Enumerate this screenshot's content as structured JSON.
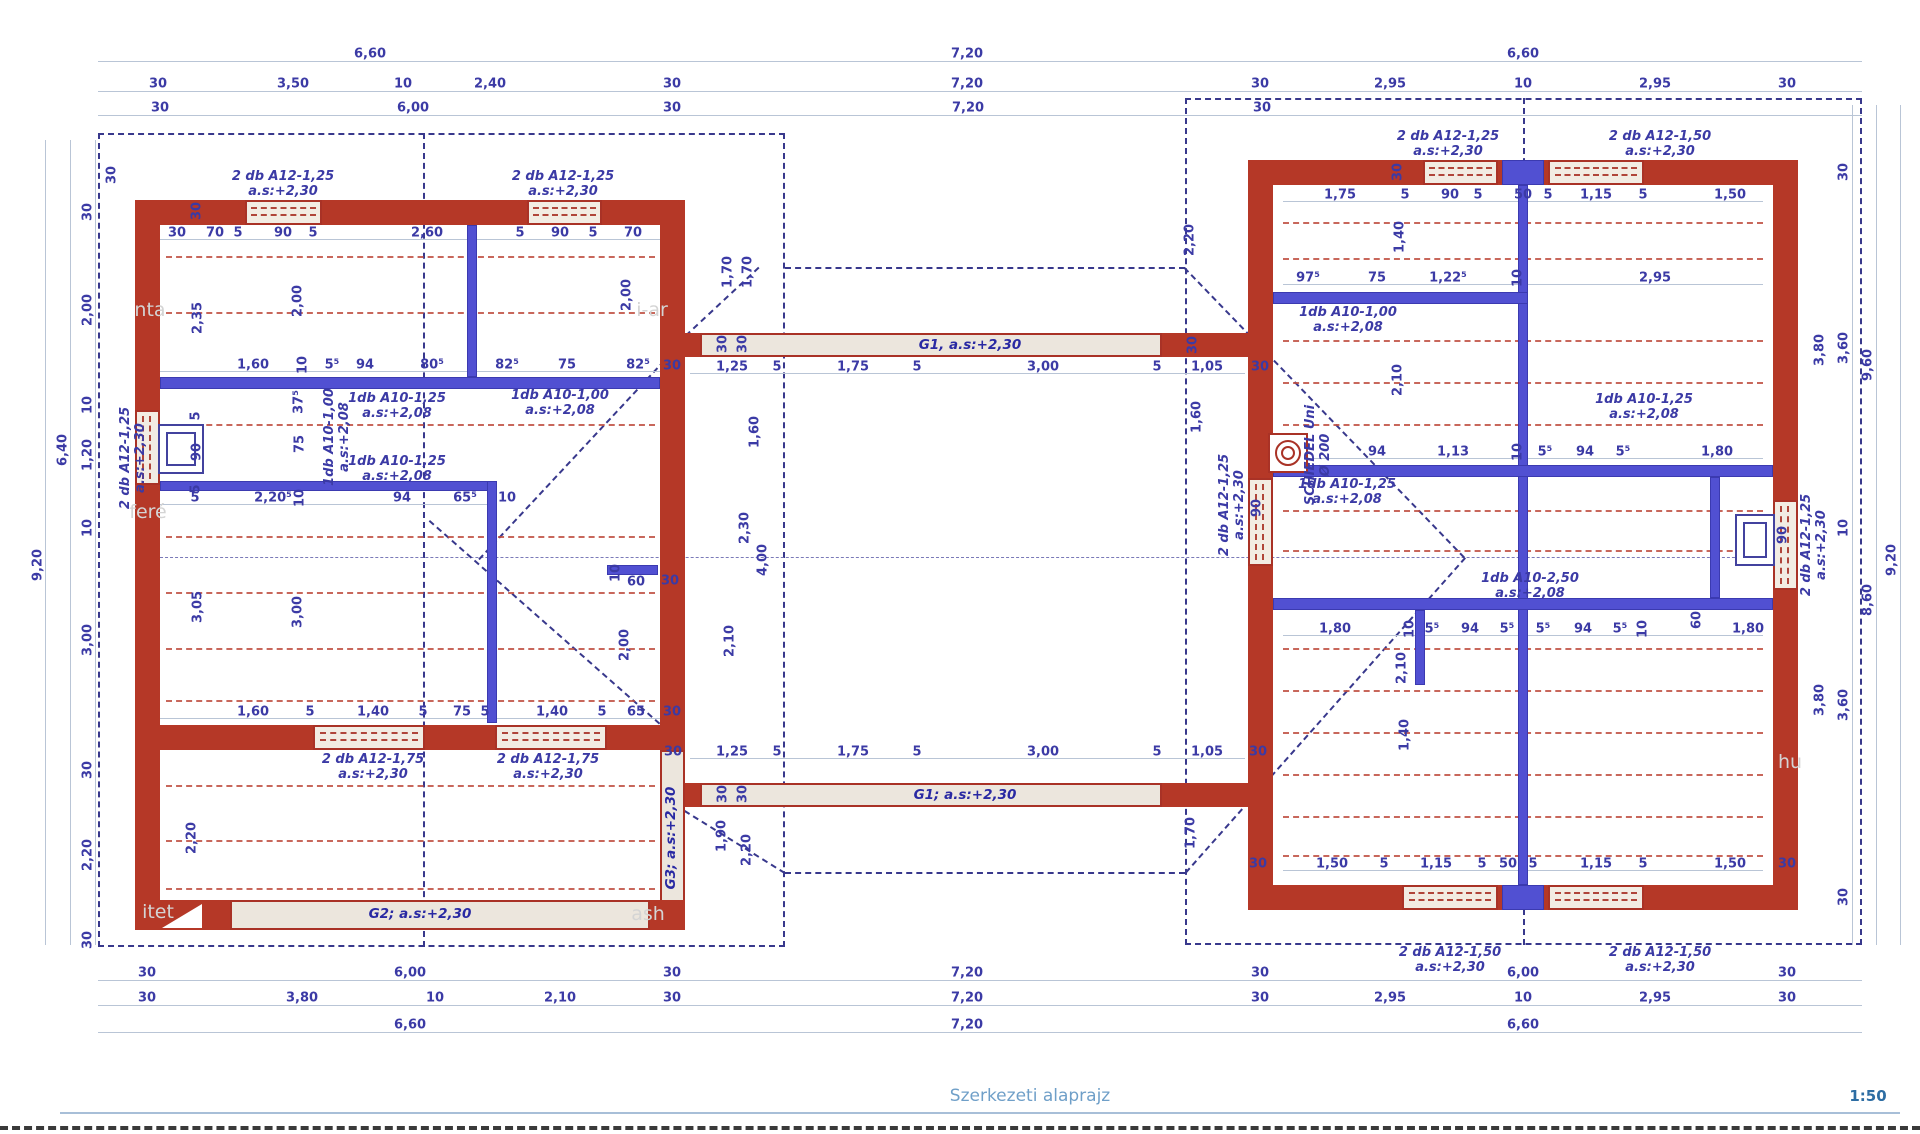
{
  "meta": {
    "title": "Szerkezeti alaprajz",
    "scale": "1:50"
  },
  "colors": {
    "wall": "#b53827",
    "reinforcement_blue": "#5150d2",
    "dimension_text": "#3b3aa5",
    "roof_dash": "#38388c",
    "slab_line": "#bf4d3f",
    "title": "#6f9fc8",
    "scale_text": "#2d6da3"
  },
  "dims": [
    {
      "t": "6,60",
      "x": 370,
      "y": 54
    },
    {
      "t": "7,20",
      "x": 967,
      "y": 54
    },
    {
      "t": "6,60",
      "x": 1523,
      "y": 54
    },
    {
      "t": "30",
      "x": 158,
      "y": 84
    },
    {
      "t": "3,50",
      "x": 293,
      "y": 84
    },
    {
      "t": "10",
      "x": 403,
      "y": 84
    },
    {
      "t": "2,40",
      "x": 490,
      "y": 84
    },
    {
      "t": "30",
      "x": 672,
      "y": 84
    },
    {
      "t": "7,20",
      "x": 967,
      "y": 84
    },
    {
      "t": "30",
      "x": 1260,
      "y": 84
    },
    {
      "t": "2,95",
      "x": 1390,
      "y": 84
    },
    {
      "t": "10",
      "x": 1523,
      "y": 84
    },
    {
      "t": "2,95",
      "x": 1655,
      "y": 84
    },
    {
      "t": "30",
      "x": 1787,
      "y": 84
    },
    {
      "t": "30",
      "x": 160,
      "y": 108
    },
    {
      "t": "6,00",
      "x": 413,
      "y": 108
    },
    {
      "t": "30",
      "x": 672,
      "y": 108
    },
    {
      "t": "7,20",
      "x": 968,
      "y": 108
    },
    {
      "t": "30",
      "x": 1262,
      "y": 108
    },
    {
      "t": "30",
      "x": 177,
      "y": 233
    },
    {
      "t": "70",
      "x": 215,
      "y": 233
    },
    {
      "t": "5",
      "x": 238,
      "y": 233
    },
    {
      "t": "90",
      "x": 283,
      "y": 233
    },
    {
      "t": "5",
      "x": 313,
      "y": 233
    },
    {
      "t": "2,60",
      "x": 427,
      "y": 233
    },
    {
      "t": "5",
      "x": 520,
      "y": 233
    },
    {
      "t": "90",
      "x": 560,
      "y": 233
    },
    {
      "t": "5",
      "x": 593,
      "y": 233
    },
    {
      "t": "70",
      "x": 633,
      "y": 233
    },
    {
      "t": "30",
      "x": 197,
      "y": 211,
      "r": 1
    },
    {
      "t": "2,35",
      "x": 198,
      "y": 318,
      "r": 1
    },
    {
      "t": "2,00",
      "x": 298,
      "y": 301,
      "r": 1
    },
    {
      "t": "2,00",
      "x": 627,
      "y": 295,
      "r": 1
    },
    {
      "t": "1,60",
      "x": 253,
      "y": 365
    },
    {
      "t": "10",
      "x": 303,
      "y": 365,
      "r": 1
    },
    {
      "t": "5⁵",
      "x": 332,
      "y": 365
    },
    {
      "t": "94",
      "x": 365,
      "y": 365
    },
    {
      "t": "80⁵",
      "x": 432,
      "y": 365
    },
    {
      "t": "82⁵",
      "x": 507,
      "y": 365
    },
    {
      "t": "75",
      "x": 567,
      "y": 365
    },
    {
      "t": "82⁵",
      "x": 638,
      "y": 365
    },
    {
      "t": "30",
      "x": 672,
      "y": 366
    },
    {
      "t": "37⁵",
      "x": 299,
      "y": 402,
      "r": 1
    },
    {
      "t": "75",
      "x": 300,
      "y": 444,
      "r": 1
    },
    {
      "t": "5",
      "x": 196,
      "y": 416,
      "r": 1
    },
    {
      "t": "90",
      "x": 197,
      "y": 452,
      "r": 1
    },
    {
      "t": "5",
      "x": 196,
      "y": 489,
      "r": 1
    },
    {
      "t": "5",
      "x": 195,
      "y": 498
    },
    {
      "t": "2,20⁵",
      "x": 273,
      "y": 498
    },
    {
      "t": "10",
      "x": 300,
      "y": 498,
      "r": 1
    },
    {
      "t": "94",
      "x": 402,
      "y": 498
    },
    {
      "t": "65⁵",
      "x": 465,
      "y": 498
    },
    {
      "t": "10",
      "x": 507,
      "y": 498
    },
    {
      "t": "10",
      "x": 616,
      "y": 573,
      "r": 1
    },
    {
      "t": "60",
      "x": 636,
      "y": 582
    },
    {
      "t": "30",
      "x": 670,
      "y": 581
    },
    {
      "t": "3,05",
      "x": 198,
      "y": 607,
      "r": 1
    },
    {
      "t": "3,00",
      "x": 298,
      "y": 612,
      "r": 1
    },
    {
      "t": "2,00",
      "x": 625,
      "y": 645,
      "r": 1
    },
    {
      "t": "1,60",
      "x": 253,
      "y": 712
    },
    {
      "t": "5",
      "x": 310,
      "y": 712
    },
    {
      "t": "1,40",
      "x": 373,
      "y": 712
    },
    {
      "t": "5",
      "x": 423,
      "y": 712
    },
    {
      "t": "75",
      "x": 462,
      "y": 712
    },
    {
      "t": "5",
      "x": 485,
      "y": 712
    },
    {
      "t": "1,40",
      "x": 552,
      "y": 712
    },
    {
      "t": "5",
      "x": 602,
      "y": 712
    },
    {
      "t": "65",
      "x": 636,
      "y": 712
    },
    {
      "t": "30",
      "x": 672,
      "y": 712
    },
    {
      "t": "2,20",
      "x": 192,
      "y": 838,
      "r": 1
    },
    {
      "t": "30",
      "x": 88,
      "y": 212,
      "r": 1
    },
    {
      "t": "2,00",
      "x": 88,
      "y": 310,
      "r": 1
    },
    {
      "t": "10",
      "x": 88,
      "y": 405,
      "r": 1
    },
    {
      "t": "1,20",
      "x": 88,
      "y": 455,
      "r": 1
    },
    {
      "t": "10",
      "x": 88,
      "y": 528,
      "r": 1
    },
    {
      "t": "3,00",
      "x": 88,
      "y": 640,
      "r": 1
    },
    {
      "t": "30",
      "x": 88,
      "y": 770,
      "r": 1
    },
    {
      "t": "2,20",
      "x": 88,
      "y": 855,
      "r": 1
    },
    {
      "t": "30",
      "x": 88,
      "y": 940,
      "r": 1
    },
    {
      "t": "30",
      "x": 112,
      "y": 175,
      "r": 1
    },
    {
      "t": "6,40",
      "x": 63,
      "y": 450,
      "r": 1
    },
    {
      "t": "9,20",
      "x": 38,
      "y": 565,
      "r": 1
    },
    {
      "t": "1,70",
      "x": 728,
      "y": 272,
      "r": 1
    },
    {
      "t": "1,70",
      "x": 748,
      "y": 272,
      "r": 1
    },
    {
      "t": "1,25",
      "x": 732,
      "y": 367
    },
    {
      "t": "5",
      "x": 777,
      "y": 367
    },
    {
      "t": "1,75",
      "x": 853,
      "y": 367
    },
    {
      "t": "5",
      "x": 917,
      "y": 367
    },
    {
      "t": "3,00",
      "x": 1043,
      "y": 367
    },
    {
      "t": "5",
      "x": 1157,
      "y": 367
    },
    {
      "t": "1,05",
      "x": 1207,
      "y": 367
    },
    {
      "t": "30",
      "x": 1260,
      "y": 367
    },
    {
      "t": "30",
      "x": 723,
      "y": 344,
      "r": 1
    },
    {
      "t": "30",
      "x": 743,
      "y": 344,
      "r": 1
    },
    {
      "t": "30",
      "x": 1193,
      "y": 345,
      "r": 1
    },
    {
      "t": "2,20",
      "x": 1190,
      "y": 240,
      "r": 1
    },
    {
      "t": "1,60",
      "x": 755,
      "y": 432,
      "r": 1
    },
    {
      "t": "2,30",
      "x": 745,
      "y": 528,
      "r": 1
    },
    {
      "t": "4,00",
      "x": 763,
      "y": 560,
      "r": 1
    },
    {
      "t": "2,10",
      "x": 730,
      "y": 641,
      "r": 1
    },
    {
      "t": "30",
      "x": 673,
      "y": 752
    },
    {
      "t": "1,25",
      "x": 732,
      "y": 752
    },
    {
      "t": "5",
      "x": 777,
      "y": 752
    },
    {
      "t": "1,75",
      "x": 853,
      "y": 752
    },
    {
      "t": "5",
      "x": 917,
      "y": 752
    },
    {
      "t": "3,00",
      "x": 1043,
      "y": 752
    },
    {
      "t": "5",
      "x": 1157,
      "y": 752
    },
    {
      "t": "1,05",
      "x": 1207,
      "y": 752
    },
    {
      "t": "30",
      "x": 1258,
      "y": 752
    },
    {
      "t": "30",
      "x": 723,
      "y": 794,
      "r": 1
    },
    {
      "t": "30",
      "x": 743,
      "y": 794,
      "r": 1
    },
    {
      "t": "1,90",
      "x": 722,
      "y": 836,
      "r": 1
    },
    {
      "t": "2,20",
      "x": 747,
      "y": 850,
      "r": 1
    },
    {
      "t": "1,70",
      "x": 1191,
      "y": 833,
      "r": 1
    },
    {
      "t": "1,60",
      "x": 1197,
      "y": 417,
      "r": 1
    },
    {
      "t": "1,75",
      "x": 1340,
      "y": 195
    },
    {
      "t": "5",
      "x": 1405,
      "y": 195
    },
    {
      "t": "90",
      "x": 1450,
      "y": 195
    },
    {
      "t": "5",
      "x": 1478,
      "y": 195
    },
    {
      "t": "50",
      "x": 1523,
      "y": 195
    },
    {
      "t": "5",
      "x": 1548,
      "y": 195
    },
    {
      "t": "1,15",
      "x": 1596,
      "y": 195
    },
    {
      "t": "5",
      "x": 1643,
      "y": 195
    },
    {
      "t": "1,50",
      "x": 1730,
      "y": 195
    },
    {
      "t": "30",
      "x": 1398,
      "y": 172,
      "r": 1
    },
    {
      "t": "97⁵",
      "x": 1308,
      "y": 278
    },
    {
      "t": "75",
      "x": 1377,
      "y": 278
    },
    {
      "t": "1,22⁵",
      "x": 1448,
      "y": 278
    },
    {
      "t": "10",
      "x": 1518,
      "y": 278,
      "r": 1
    },
    {
      "t": "2,95",
      "x": 1655,
      "y": 278
    },
    {
      "t": "1,40",
      "x": 1400,
      "y": 237,
      "r": 1
    },
    {
      "t": "2,10",
      "x": 1398,
      "y": 380,
      "r": 1
    },
    {
      "t": "94",
      "x": 1377,
      "y": 452
    },
    {
      "t": "1,13",
      "x": 1453,
      "y": 452
    },
    {
      "t": "10",
      "x": 1518,
      "y": 452,
      "r": 1
    },
    {
      "t": "5⁵",
      "x": 1545,
      "y": 452
    },
    {
      "t": "94",
      "x": 1585,
      "y": 452
    },
    {
      "t": "5⁵",
      "x": 1623,
      "y": 452
    },
    {
      "t": "1,80",
      "x": 1717,
      "y": 452
    },
    {
      "t": "1,80",
      "x": 1335,
      "y": 629
    },
    {
      "t": "10",
      "x": 1410,
      "y": 629,
      "r": 1
    },
    {
      "t": "5⁵",
      "x": 1432,
      "y": 629
    },
    {
      "t": "94",
      "x": 1470,
      "y": 629
    },
    {
      "t": "5⁵",
      "x": 1507,
      "y": 629
    },
    {
      "t": "5⁵",
      "x": 1543,
      "y": 629
    },
    {
      "t": "94",
      "x": 1583,
      "y": 629
    },
    {
      "t": "5⁵",
      "x": 1620,
      "y": 629
    },
    {
      "t": "10",
      "x": 1643,
      "y": 629,
      "r": 1
    },
    {
      "t": "60",
      "x": 1697,
      "y": 620,
      "r": 1
    },
    {
      "t": "1,80",
      "x": 1748,
      "y": 629
    },
    {
      "t": "2,10",
      "x": 1402,
      "y": 668,
      "r": 1
    },
    {
      "t": "1,40",
      "x": 1405,
      "y": 735,
      "r": 1
    },
    {
      "t": "30",
      "x": 1258,
      "y": 864
    },
    {
      "t": "1,50",
      "x": 1332,
      "y": 864
    },
    {
      "t": "5",
      "x": 1384,
      "y": 864
    },
    {
      "t": "1,15",
      "x": 1436,
      "y": 864
    },
    {
      "t": "5",
      "x": 1482,
      "y": 864
    },
    {
      "t": "50",
      "x": 1508,
      "y": 864
    },
    {
      "t": "5",
      "x": 1533,
      "y": 864
    },
    {
      "t": "1,15",
      "x": 1596,
      "y": 864
    },
    {
      "t": "5",
      "x": 1643,
      "y": 864
    },
    {
      "t": "1,50",
      "x": 1730,
      "y": 864
    },
    {
      "t": "30",
      "x": 1787,
      "y": 864
    },
    {
      "t": "90",
      "x": 1257,
      "y": 508,
      "r": 1
    },
    {
      "t": "90",
      "x": 1783,
      "y": 535,
      "r": 1
    },
    {
      "t": "3,80",
      "x": 1820,
      "y": 350,
      "r": 1
    },
    {
      "t": "3,80",
      "x": 1820,
      "y": 700,
      "r": 1
    },
    {
      "t": "30",
      "x": 1844,
      "y": 172,
      "r": 1
    },
    {
      "t": "3,60",
      "x": 1844,
      "y": 348,
      "r": 1
    },
    {
      "t": "10",
      "x": 1844,
      "y": 528,
      "r": 1
    },
    {
      "t": "3,60",
      "x": 1844,
      "y": 705,
      "r": 1
    },
    {
      "t": "30",
      "x": 1844,
      "y": 897,
      "r": 1
    },
    {
      "t": "9,60",
      "x": 1868,
      "y": 365,
      "r": 1
    },
    {
      "t": "8,60",
      "x": 1868,
      "y": 600,
      "r": 1
    },
    {
      "t": "9,20",
      "x": 1892,
      "y": 560,
      "r": 1
    },
    {
      "t": "30",
      "x": 147,
      "y": 973
    },
    {
      "t": "6,00",
      "x": 410,
      "y": 973
    },
    {
      "t": "30",
      "x": 672,
      "y": 973
    },
    {
      "t": "7,20",
      "x": 967,
      "y": 973
    },
    {
      "t": "30",
      "x": 1260,
      "y": 973
    },
    {
      "t": "6,00",
      "x": 1523,
      "y": 973
    },
    {
      "t": "30",
      "x": 1787,
      "y": 973
    },
    {
      "t": "30",
      "x": 147,
      "y": 998
    },
    {
      "t": "3,80",
      "x": 302,
      "y": 998
    },
    {
      "t": "10",
      "x": 435,
      "y": 998
    },
    {
      "t": "2,10",
      "x": 560,
      "y": 998
    },
    {
      "t": "30",
      "x": 672,
      "y": 998
    },
    {
      "t": "7,20",
      "x": 967,
      "y": 998
    },
    {
      "t": "30",
      "x": 1260,
      "y": 998
    },
    {
      "t": "2,95",
      "x": 1390,
      "y": 998
    },
    {
      "t": "10",
      "x": 1523,
      "y": 998
    },
    {
      "t": "2,95",
      "x": 1655,
      "y": 998
    },
    {
      "t": "30",
      "x": 1787,
      "y": 998
    },
    {
      "t": "6,60",
      "x": 410,
      "y": 1025
    },
    {
      "t": "7,20",
      "x": 967,
      "y": 1025
    },
    {
      "t": "6,60",
      "x": 1523,
      "y": 1025
    }
  ],
  "rebar_labels": [
    {
      "a": "2 db A12-1,25",
      "b": "a.s:+2,30",
      "x": 283,
      "y": 184
    },
    {
      "a": "2 db A12-1,25",
      "b": "a.s:+2,30",
      "x": 563,
      "y": 184
    },
    {
      "a": "2 db A12-1,25",
      "b": "a.s:+2,30",
      "x": 133,
      "y": 458,
      "r": 1
    },
    {
      "a": "2 db A12-1,75",
      "b": "a.s:+2,30",
      "x": 373,
      "y": 767
    },
    {
      "a": "2 db A12-1,75",
      "b": "a.s:+2,30",
      "x": 548,
      "y": 767
    },
    {
      "a": "2 db A12-1,25",
      "b": "a.s:+2,30",
      "x": 1448,
      "y": 144
    },
    {
      "a": "2 db A12-1,50",
      "b": "a.s:+2,30",
      "x": 1660,
      "y": 144
    },
    {
      "a": "2 db A12-1,50",
      "b": "a.s:+2,30",
      "x": 1450,
      "y": 960
    },
    {
      "a": "2 db A12-1,50",
      "b": "a.s:+2,30",
      "x": 1660,
      "y": 960
    },
    {
      "a": "2 db A12-1,25",
      "b": "a.s:+2,30",
      "x": 1232,
      "y": 505,
      "r": 1
    },
    {
      "a": "2 db A12-1,25",
      "b": "a.s:+2,30",
      "x": 1814,
      "y": 545,
      "r": 1
    },
    {
      "a": "1db A10-1,25",
      "b": "a.s:+2,08",
      "x": 397,
      "y": 406
    },
    {
      "a": "1db A10-1,00",
      "b": "a.s:+2,08",
      "x": 560,
      "y": 403
    },
    {
      "a": "1db A10-1,00",
      "b": "a.s:+2,08",
      "x": 337,
      "y": 437,
      "r": 1
    },
    {
      "a": "1db A10-1,25",
      "b": "a.s:+2,08",
      "x": 397,
      "y": 469
    },
    {
      "a": "1db A10-1,00",
      "b": "a.s:+2,08",
      "x": 1348,
      "y": 320
    },
    {
      "a": "1db A10-1,25",
      "b": "a.s:+2,08",
      "x": 1644,
      "y": 407
    },
    {
      "a": "1db A10-1,25",
      "b": "a.s:+2,08",
      "x": 1347,
      "y": 492
    },
    {
      "a": "1db A10-2,50",
      "b": "a.s:+2,08",
      "x": 1530,
      "y": 586
    },
    {
      "a": "SCHIEDEL Uni",
      "b": "Ø 200",
      "x": 1318,
      "y": 455,
      "r": 1,
      "n": "chimney-label"
    }
  ],
  "beam_labels": [
    {
      "t": "G1, a.s:+2,30",
      "x": 970,
      "y": 345
    },
    {
      "t": "G1; a.s:+2,30",
      "x": 965,
      "y": 795
    },
    {
      "t": "G2; a.s:+2,30",
      "x": 420,
      "y": 914
    },
    {
      "t": "G3; a.s:+2,30",
      "x": 671,
      "y": 838,
      "r": 1
    }
  ],
  "watermarks": [
    {
      "t": "nta",
      "x": 150,
      "y": 310
    },
    {
      "t": "feré",
      "x": 148,
      "y": 512
    },
    {
      "t": "i-ar",
      "x": 652,
      "y": 310
    },
    {
      "t": "itet",
      "x": 158,
      "y": 912
    },
    {
      "t": "ash",
      "x": 648,
      "y": 914
    },
    {
      "t": "hu",
      "x": 1790,
      "y": 762
    }
  ]
}
